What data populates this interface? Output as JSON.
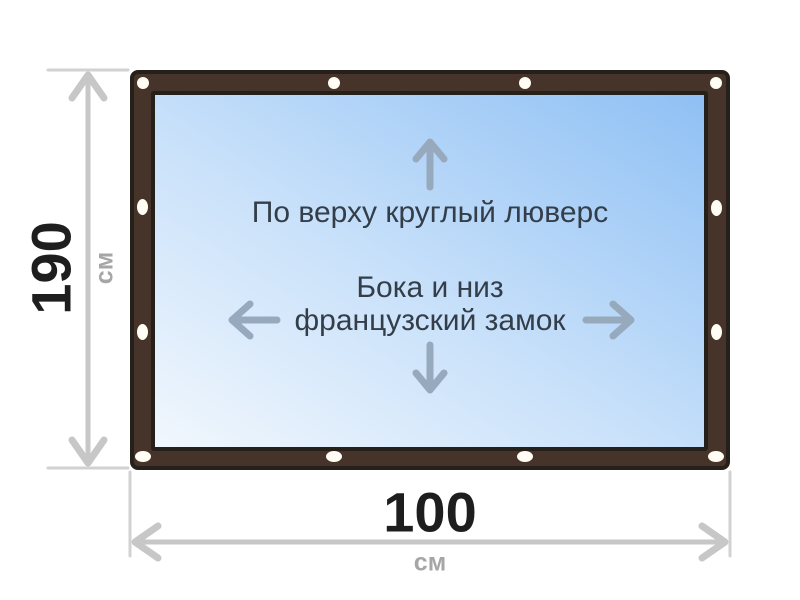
{
  "figure": {
    "type": "product-dimension-diagram",
    "notes": {
      "top": "По верху круглый люверс",
      "middle_line1": "Бока и низ",
      "middle_line2": "французский замок"
    },
    "dimensions": {
      "height": {
        "value": "190",
        "unit": "см"
      },
      "width": {
        "value": "100",
        "unit": "см"
      }
    },
    "icons": {
      "arrow_up": "↑",
      "arrow_down": "↓",
      "arrow_left": "←",
      "arrow_right": "→",
      "grommet": "white-oval-eyelet",
      "dimension_arrows": "double-headed-chevron-lines"
    },
    "colors": {
      "frame_brown": "#46342a",
      "outline_dark": "#26201b",
      "sheet_gradient_light": "#f1f7fd",
      "sheet_gradient_blue": "#8fc0f4",
      "grommet_white": "#fffdf4",
      "dimension_line_gray": "#c7c7c7",
      "extension_line_gray": "#d2d2d2",
      "dimension_value_black": "#1e1e1e",
      "dimension_unit_gray": "#a6a6a6",
      "inner_arrow_blue_gray": "#97aabd",
      "note_text": "#333e49"
    }
  }
}
